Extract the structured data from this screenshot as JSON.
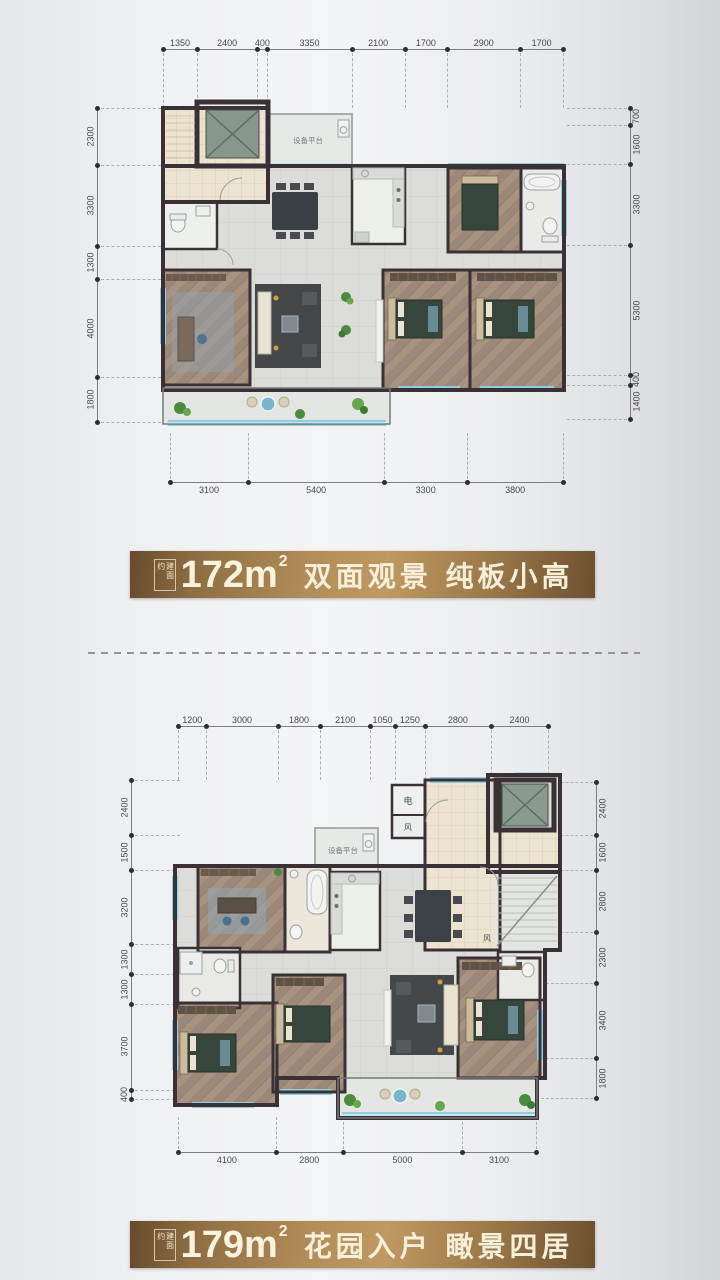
{
  "colors": {
    "banner_gold": "#b48e5a",
    "wall": "#3a3136",
    "window_blue": "#8fcde2",
    "background": "#eceDEF"
  },
  "plan1": {
    "dims": {
      "top": [
        1350,
        2400,
        400,
        3350,
        2100,
        1700,
        2900,
        1700
      ],
      "bottom": [
        3100,
        5400,
        3300,
        3800
      ],
      "left": [
        2300,
        3300,
        1300,
        4000,
        1800
      ],
      "right": [
        700,
        1600,
        3300,
        5300,
        400,
        1400
      ]
    },
    "labels": {
      "platform": "设备平台"
    },
    "banner": {
      "prefix": "建面约",
      "area": "172m",
      "sup": "2",
      "title": "双面观景 纯板小高"
    }
  },
  "plan2": {
    "dims": {
      "top": [
        1200,
        3000,
        1800,
        2100,
        1050,
        1250,
        2800,
        2400
      ],
      "bottom": [
        4100,
        2800,
        5000,
        3100
      ],
      "left": [
        2400,
        1500,
        3200,
        1300,
        1300,
        3700,
        400
      ],
      "right": [
        2400,
        1600,
        2800,
        2300,
        3400,
        1800
      ]
    },
    "labels": {
      "platform": "设备平台",
      "elec": "电",
      "vent_a": "风",
      "vent_b": "风"
    },
    "banner": {
      "prefix": "建面约",
      "area": "179m",
      "sup": "2",
      "title": "花园入户 瞰景四居"
    }
  }
}
